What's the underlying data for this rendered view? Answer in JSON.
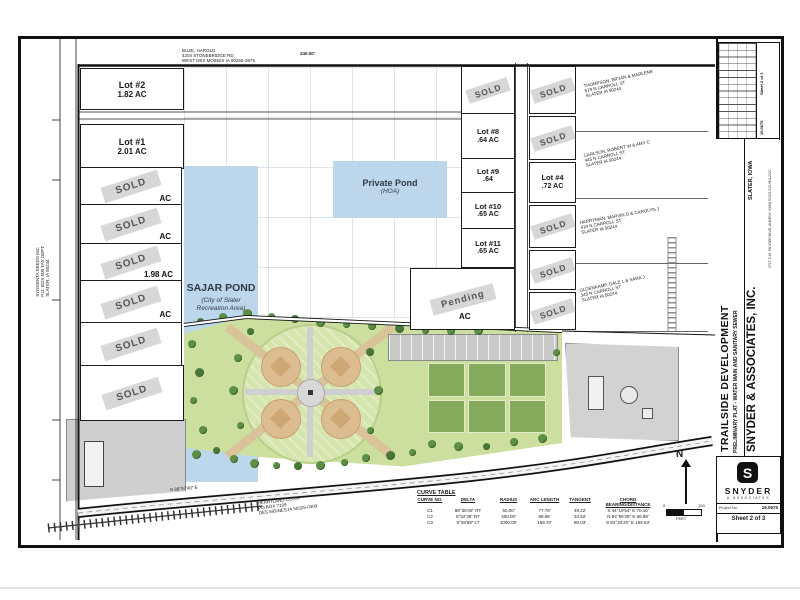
{
  "title_block": {
    "project_title": "TRAILSIDE DEVELOPMENT",
    "sheet_subtitle": "PRELIMINARY PLAT - WATER MAIN AND SANITARY SEWER",
    "location": "SLATER, IOWA",
    "firm_name": "SNYDER & ASSOCIATES, INC.",
    "firm_address": "2727 S.W. SNYDER BLVD.  ANKENY, IOWA 50023  515-964-2020",
    "logo_word": "SNYDER",
    "logo_subword": "& ASSOCIATES",
    "project_no_label": "Project No:",
    "project_no": "19.0675",
    "sheet_label": "Sheet 2 of 3",
    "rev_sheet": "Sheet 2 of 3",
    "rev_project": "19.0675"
  },
  "labels": {
    "sold": "SOLD",
    "pending": "Pending"
  },
  "lots": {
    "lot2": {
      "name": "Lot #2",
      "area": "1.82 AC"
    },
    "lot1": {
      "name": "Lot #1",
      "area": "2.01 AC"
    },
    "lot8": {
      "name": "Lot #8",
      "area": ".64 AC"
    },
    "lot9": {
      "name": "Lot #9",
      "area": ".64"
    },
    "lot10": {
      "name": "Lot #10",
      "area": ".65 AC"
    },
    "lot11": {
      "name": "Lot #11",
      "area": ".65 AC"
    },
    "lot4": {
      "name": "Lot #4",
      "area": ".72 AC"
    }
  },
  "fragments": {
    "f1": "AC",
    "f2": "AC",
    "f3": "1.98 AC",
    "f4": "AC",
    "pending": "AC"
  },
  "ponds": {
    "sajar": {
      "name": "SAJAR POND",
      "note": "(City of Slater Recreation Area)"
    },
    "private": {
      "name": "Private Pond",
      "note": "(HOA)"
    }
  },
  "owners": {
    "buze": {
      "l1": "BUZE, HAROLD",
      "l2": "4204 STONEBRIDGE RD",
      "l3": "WEST DES MOINES IA 50265-3875"
    },
    "syngenta": {
      "l1": "SYNGENTA SEEDS INC",
      "l2": "P.O. BOX 500 TAX DEPT",
      "l3": "SLATER, IA 50244"
    },
    "heartland": {
      "l1": "HEARTLAND CO-OP",
      "l2": "PO BOX 7109",
      "l3": "DES MOINES IA 50325-0309"
    },
    "thompson": {
      "l1": "THOMPSON, BRYAN & MARLENE",
      "l2": "519 N CARROLL ST",
      "l3": "SLATER IA 50244"
    },
    "carlson": {
      "l1": "CARLSON, ROBERT W & AMY C",
      "l2": "445 N CARROLL ST",
      "l3": "SLATER IA 50244"
    },
    "harryman": {
      "l1": "HARRYMAN, MARVIN D & CAROLYN J",
      "l2": "419 N CARROLL ST",
      "l3": "SLATER IA 50244"
    },
    "oldenkamp": {
      "l1": "OLDENKAMP, DALE L & SARA J",
      "l2": "345 N CARROLL ST",
      "l3": "SLATER IA 50244"
    }
  },
  "dims": {
    "top_dim": "240.00'",
    "bottom_bearing": "S 89°57'40\" E"
  },
  "north": {
    "n": "N",
    "zero": "0",
    "hundred": "100",
    "unit": "FEET"
  },
  "curve_table": {
    "title": "CURVE TABLE",
    "headers": [
      "CURVE NO.",
      "DELTA",
      "RADIUS",
      "ARC LENGTH",
      "TANGENT",
      "CHORD BEARING/DISTANCE"
    ],
    "rows": [
      [
        "C1",
        "88°36'48\" RT",
        "50.00'",
        "77.78'",
        "49.22'",
        "S 44°19'54\" E  70.16'"
      ],
      [
        "C2",
        "9°52'38\" RT",
        "400.00'",
        "68.96'",
        "34.52'",
        "N 84°56'25\" E  68.88'"
      ],
      [
        "C3",
        "9°08'59\" LT",
        "1000.00'",
        "159.70'",
        "80.03'",
        "S 84°34'20\" E  159.53'"
      ]
    ]
  },
  "colors": {
    "pond": "#bcd6ec",
    "park": "#cddf9f",
    "sold_stamp": "#d5d5d5",
    "parcel_gray": "#cfcfcf",
    "line": "#1a1a1a"
  }
}
